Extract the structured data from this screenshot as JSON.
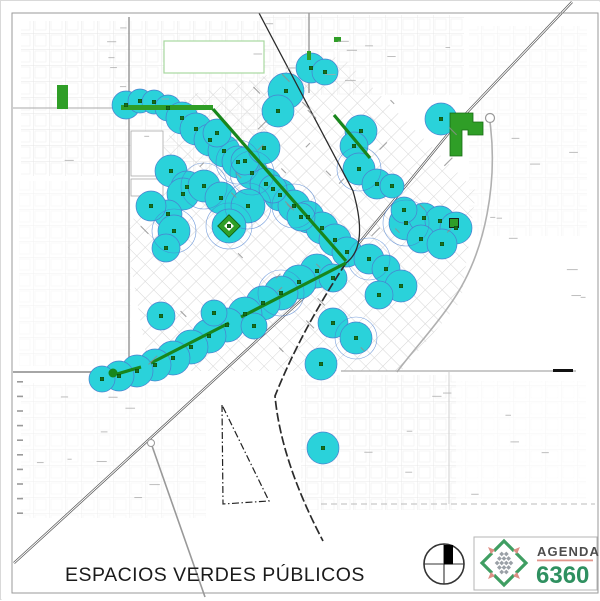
{
  "title_block": {
    "title": "ESPACIOS VERDES PÚBLICOS"
  },
  "logo": {
    "brand": "AGENDA",
    "number": "6360"
  },
  "map": {
    "colors": {
      "coverage_fill": "#2ad2da",
      "coverage_stroke": "#4a7fd0",
      "park_green": "#2f9e27",
      "boulevard_green": "#18861c",
      "mark_green": "#17701a",
      "road_gray": "#8a8a8a",
      "rail_dark": "#2b2b2b",
      "grid_light": "#e0e0e0",
      "grid_diag": "#d6d6d6",
      "logo_green": "#3f9e62",
      "logo_salmon": "#dd8f85",
      "logo_gray": "#9aa0a6",
      "logo_text_gray": "#4d4d4d",
      "title_color": "#1b1b1b"
    },
    "coverage_circles": [
      [
        125,
        104,
        14
      ],
      [
        139,
        100,
        12
      ],
      [
        153,
        101,
        12
      ],
      [
        167,
        107,
        13
      ],
      [
        181,
        117,
        16
      ],
      [
        195,
        128,
        16
      ],
      [
        209,
        139,
        16
      ],
      [
        223,
        150,
        16
      ],
      [
        237,
        161,
        16
      ],
      [
        251,
        172,
        16
      ],
      [
        265,
        183,
        16
      ],
      [
        279,
        194,
        16
      ],
      [
        293,
        205,
        16
      ],
      [
        307,
        216,
        16
      ],
      [
        321,
        227,
        16
      ],
      [
        334,
        239,
        16
      ],
      [
        346,
        251,
        15
      ],
      [
        216,
        132,
        14
      ],
      [
        244,
        160,
        14
      ],
      [
        272,
        188,
        14
      ],
      [
        300,
        216,
        14
      ],
      [
        170,
        170,
        16
      ],
      [
        186,
        186,
        16
      ],
      [
        182,
        193,
        16
      ],
      [
        203,
        185,
        16
      ],
      [
        220,
        197,
        16
      ],
      [
        247,
        205,
        17
      ],
      [
        167,
        213,
        14
      ],
      [
        150,
        205,
        15
      ],
      [
        173,
        230,
        16
      ],
      [
        165,
        247,
        14
      ],
      [
        228,
        225,
        17
      ],
      [
        316,
        270,
        17
      ],
      [
        298,
        281,
        17
      ],
      [
        280,
        292,
        17
      ],
      [
        262,
        302,
        17
      ],
      [
        244,
        313,
        17
      ],
      [
        226,
        324,
        17
      ],
      [
        208,
        335,
        17
      ],
      [
        190,
        346,
        17
      ],
      [
        172,
        357,
        17
      ],
      [
        154,
        364,
        16
      ],
      [
        136,
        370,
        16
      ],
      [
        118,
        375,
        15
      ],
      [
        101,
        378,
        13
      ],
      [
        160,
        315,
        14
      ],
      [
        213,
        312,
        13
      ],
      [
        253,
        325,
        13
      ],
      [
        310,
        67,
        15
      ],
      [
        324,
        71,
        13
      ],
      [
        285,
        90,
        18
      ],
      [
        277,
        110,
        16
      ],
      [
        263,
        147,
        16
      ],
      [
        360,
        130,
        16
      ],
      [
        353,
        145,
        14
      ],
      [
        358,
        168,
        16
      ],
      [
        376,
        183,
        15
      ],
      [
        391,
        185,
        12
      ],
      [
        405,
        222,
        17
      ],
      [
        423,
        217,
        15
      ],
      [
        439,
        220,
        15
      ],
      [
        455,
        227,
        16
      ],
      [
        420,
        238,
        14
      ],
      [
        441,
        243,
        15
      ],
      [
        403,
        209,
        13
      ],
      [
        440,
        118,
        16
      ],
      [
        368,
        258,
        15
      ],
      [
        385,
        268,
        14
      ],
      [
        400,
        285,
        16
      ],
      [
        378,
        294,
        14
      ],
      [
        332,
        277,
        14
      ],
      [
        332,
        322,
        15
      ],
      [
        355,
        337,
        16
      ],
      [
        320,
        363,
        16
      ],
      [
        322,
        447,
        16
      ]
    ],
    "outline_circles": [
      [
        203,
        185,
        23
      ],
      [
        280,
        292,
        23
      ],
      [
        358,
        168,
        22
      ],
      [
        405,
        222,
        23
      ],
      [
        228,
        225,
        23
      ],
      [
        247,
        205,
        23
      ],
      [
        173,
        230,
        22
      ],
      [
        355,
        337,
        21
      ],
      [
        368,
        258,
        21
      ],
      [
        251,
        172,
        22
      ],
      [
        293,
        205,
        22
      ],
      [
        237,
        161,
        22
      ]
    ],
    "park_rects": [
      [
        56,
        84,
        11,
        24
      ],
      [
        120,
        104,
        92,
        5
      ],
      [
        333,
        36,
        7,
        5
      ],
      [
        306,
        50,
        4,
        9
      ]
    ],
    "boulevard_segments": [
      [
        212,
        108,
        345,
        260
      ],
      [
        333,
        114,
        369,
        157
      ],
      [
        345,
        262,
        240,
        316
      ],
      [
        228,
        322,
        150,
        362
      ],
      [
        140,
        366,
        116,
        373
      ]
    ],
    "big_park_path": "M449,112 h23 v9 h10 v13 h-15 v-5 h-6 v26 h-12 z",
    "plaza_diamond_center": [
      228,
      225
    ],
    "plaza_square": [
      453,
      222,
      9
    ],
    "boulevard_end_blob": [
      112,
      372,
      4.5
    ]
  }
}
